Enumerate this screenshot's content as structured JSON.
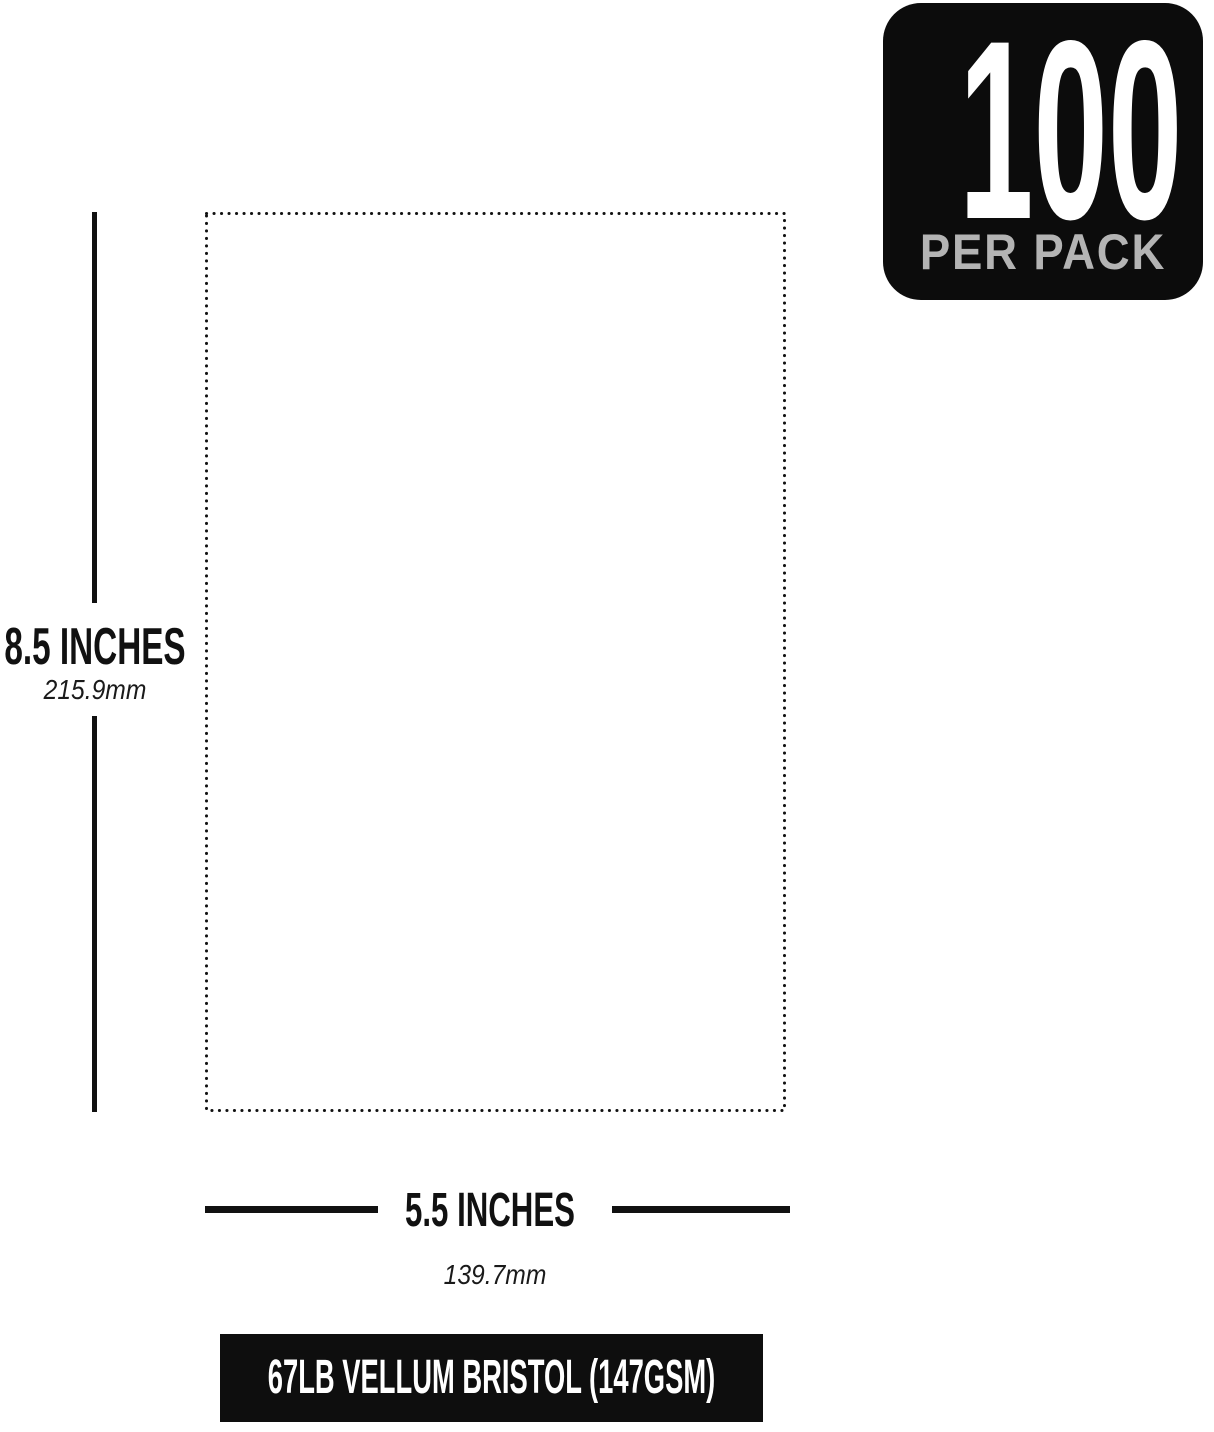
{
  "badge": {
    "count": "100",
    "label": "PER PACK",
    "bg_color": "#0c0c0c",
    "count_color": "#ffffff",
    "label_color": "#b4b4b4"
  },
  "sheet": {
    "outline_color": "#111111",
    "height": {
      "inches": "8.5 INCHES",
      "metric": "215.9mm"
    },
    "width": {
      "inches": "5.5 INCHES",
      "metric": "139.7mm"
    }
  },
  "spec_bar": {
    "label": "67LB VELLUM BRISTOL (147GSM)",
    "bg_color": "#0e0e0e",
    "text_color": "#ffffff"
  }
}
